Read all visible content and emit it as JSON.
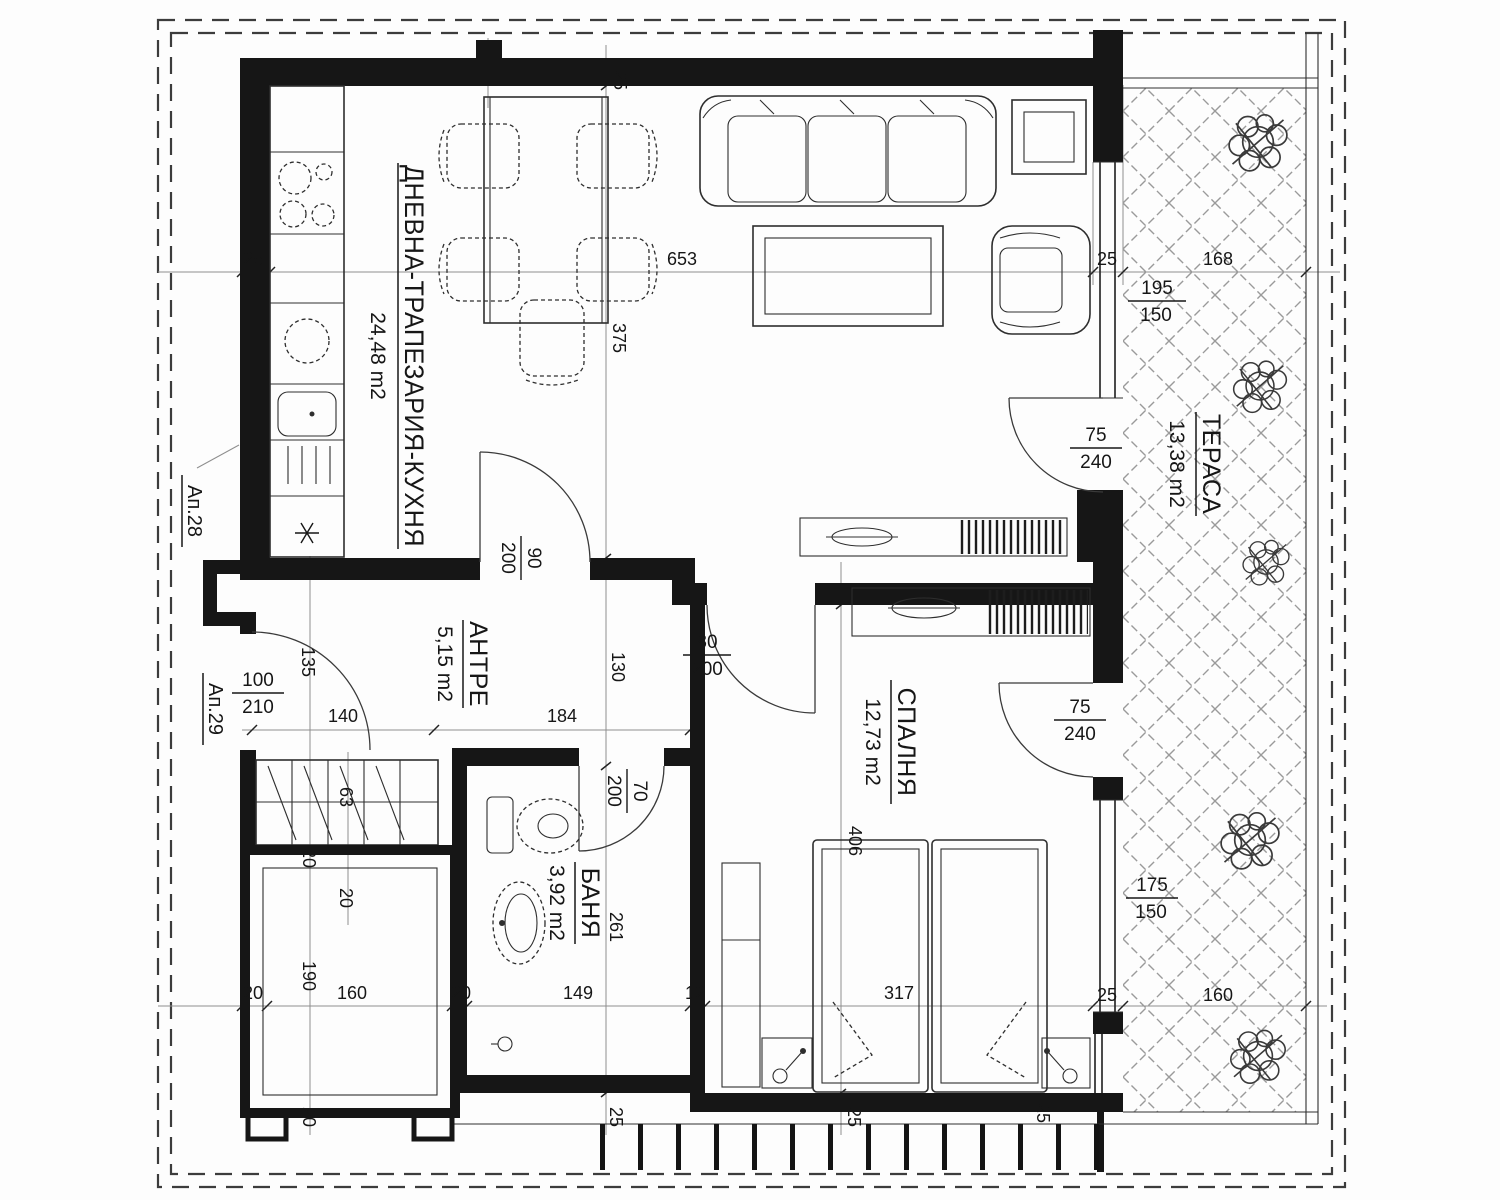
{
  "drawing": {
    "kind": "apartment floor plan",
    "language": "Bulgarian",
    "units": "cm"
  },
  "rooms": [
    {
      "name": "ДНЕВНА-ТРАПЕЗАРИЯ-КУХНЯ",
      "area": "24,48 m2"
    },
    {
      "name": "АНТРЕ",
      "area": "5,15 m2"
    },
    {
      "name": "БАНЯ",
      "area": "3,92 m2"
    },
    {
      "name": "СПАЛНЯ",
      "area": "12,73 m2"
    },
    {
      "name": "ТЕРАСА",
      "area": "13,38 m2"
    }
  ],
  "neighbors": {
    "ap28": "Ап.28",
    "ap29": "Ап.29"
  },
  "doors": {
    "entrance": {
      "num": "100",
      "den": "210"
    },
    "living": {
      "num": "90",
      "den": "200"
    },
    "bedroom": {
      "num": "80",
      "den": "200"
    },
    "bath": {
      "num": "70",
      "den": "200"
    },
    "terrace_living": {
      "num": "75",
      "den": "240"
    },
    "terrace_bedroom": {
      "num": "75",
      "den": "240"
    }
  },
  "windows": {
    "living": {
      "num": "195",
      "den": "150"
    },
    "bedroom": {
      "num": "175",
      "den": "150"
    }
  },
  "dims": {
    "top": [
      "25",
      "653",
      "25",
      "168"
    ],
    "left_axis": [
      "25",
      "375",
      "130",
      "261",
      "25"
    ],
    "bedroom_axis": [
      "406",
      "25"
    ],
    "bedroom_corner": "25",
    "hall": [
      "135",
      "140",
      "184"
    ],
    "closet": [
      "63",
      "20"
    ],
    "shaft_v": [
      "20",
      "190",
      "20"
    ],
    "bottom": [
      "20",
      "160",
      "20",
      "149",
      "12",
      "317",
      "25",
      "160"
    ]
  }
}
